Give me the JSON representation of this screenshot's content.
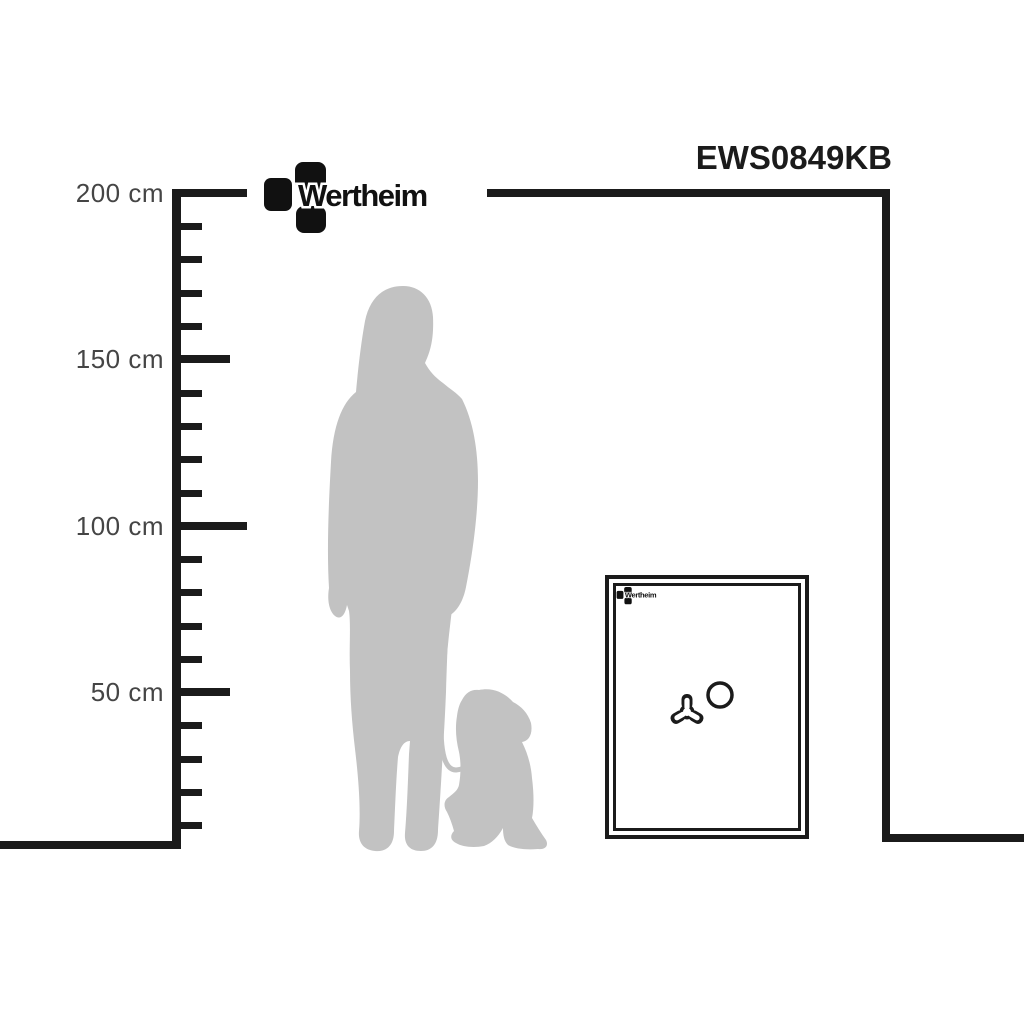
{
  "product": {
    "code": "EWS0849KB",
    "brand": "Wertheim"
  },
  "safe": {
    "brand": "Wertheim"
  },
  "ruler": {
    "unit": "cm",
    "labels": [
      {
        "text": "200 cm",
        "value": 200
      },
      {
        "text": "150 cm",
        "value": 150
      },
      {
        "text": "100 cm",
        "value": 100
      },
      {
        "text": "50 cm",
        "value": 50
      }
    ]
  },
  "icons": {
    "brand_mark": "wertheim-block-cross-mark",
    "safe_handle": "tri-spoke-handle",
    "safe_dial": "round-dial"
  },
  "colors": {
    "line": "#1b1b1b",
    "label_text": "#454545",
    "silhouette": "#c2c2c2",
    "background": "#ffffff"
  }
}
